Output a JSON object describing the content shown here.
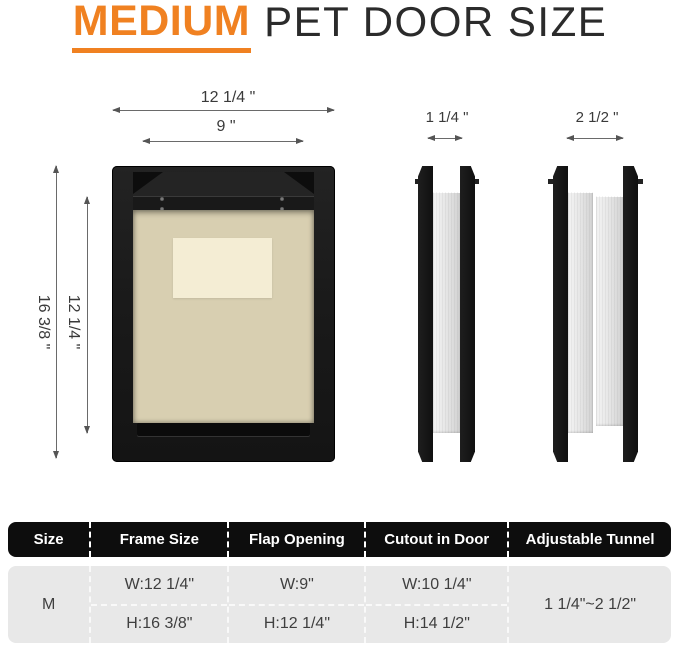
{
  "title": {
    "highlight": "MEDIUM",
    "rest": "PET DOOR SIZE"
  },
  "dimensions": {
    "front_outer_width": "12 1/4 \"",
    "front_inner_width": "9 \"",
    "front_outer_height": "16 3/8 \"",
    "front_inner_height": "12 1/4 \"",
    "tunnel_min": "1 1/4 \"",
    "tunnel_max": "2 1/2 \""
  },
  "table": {
    "headers": [
      "Size",
      "Frame Size",
      "Flap Opening",
      "Cutout in Door",
      "Adjustable Tunnel"
    ],
    "row": {
      "size": "M",
      "frame_size_w": "W:12 1/4\"",
      "frame_size_h": "H:16 3/8\"",
      "flap_opening_w": "W:9\"",
      "flap_opening_h": "H:12 1/4\"",
      "cutout_w": "W:10 1/4\"",
      "cutout_h": "H:14 1/2\"",
      "adjustable_tunnel": "1 1/4\"~2 1/2\""
    }
  },
  "colors": {
    "accent_orange": "#F08121",
    "table_header_bg": "#0D0D0D",
    "table_body_bg": "#E8E8E8",
    "frame_black": "#1A1A1A",
    "flap_cream": "#D8CFB1",
    "label_cream": "#F4EDD4",
    "tunnel_silver": "#E2E2E2"
  }
}
